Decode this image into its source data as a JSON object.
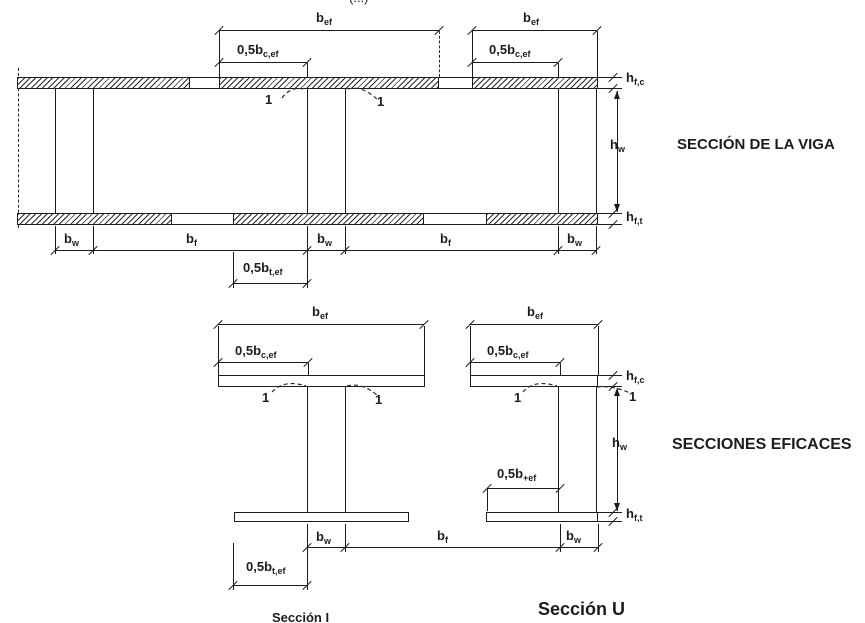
{
  "page": {
    "cropped_fragment": "(...)"
  },
  "labels": {
    "bef": {
      "main": "b",
      "sub": "ef"
    },
    "half_bcef": {
      "main": "0,5b",
      "sub": "c,ef"
    },
    "half_btef": {
      "main": "0,5b",
      "sub": "t,ef"
    },
    "half_bpef": {
      "main": "0,5b",
      "sub": "+ef"
    },
    "bw": {
      "main": "b",
      "sub": "w"
    },
    "bf": {
      "main": "b",
      "sub": "f"
    },
    "hfc": {
      "main": "h",
      "sub": "f,c"
    },
    "hw": {
      "main": "h",
      "sub": "w"
    },
    "hft": {
      "main": "h",
      "sub": "f,t"
    },
    "one": "1"
  },
  "titles": {
    "beam_section": "SECCIÓN DE LA VIGA",
    "effective_sections": "SECCIONES EFICACES",
    "section_i": "Sección I",
    "section_u": "Sección U"
  },
  "drawing": {
    "line_color": "#1c1c1c",
    "background": "#ffffff"
  }
}
